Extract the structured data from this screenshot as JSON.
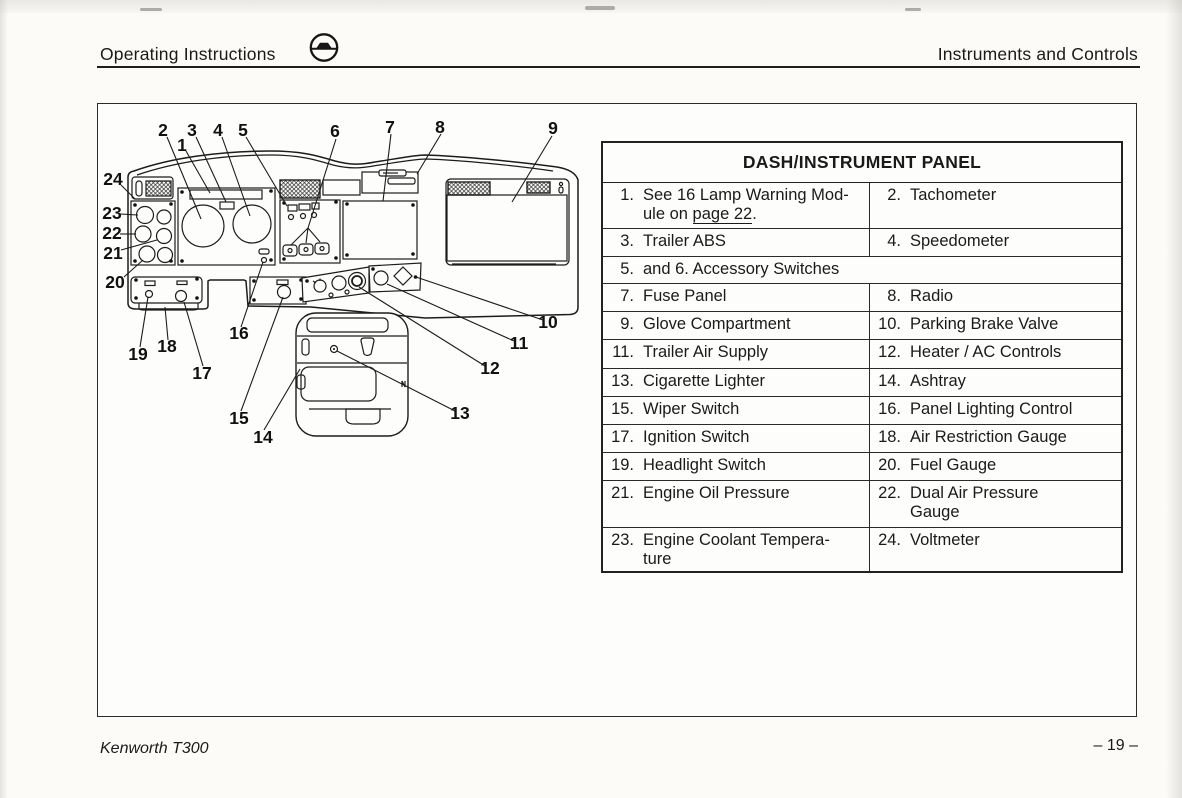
{
  "header": {
    "left": "Operating Instructions",
    "right": "Instruments and Controls",
    "icon": "steering-wheel-icon"
  },
  "footer": {
    "model": "Kenworth T300",
    "page": "– 19 –"
  },
  "table": {
    "title": "DASH/INSTRUMENT PANEL",
    "rows": [
      {
        "ln": "1.",
        "lt_pre": "See 16 Lamp Warning Mod-ule on ",
        "lt_link": "page 22",
        "lt_post": ".",
        "rn": "2.",
        "rt": "Tachometer"
      },
      {
        "ln": "3.",
        "lt": "Trailer ABS",
        "rn": "4.",
        "rt": "Speedometer"
      },
      {
        "n": "5.",
        "label": "and 6. Accessory Switches"
      },
      {
        "ln": "7.",
        "lt": "Fuse Panel",
        "rn": "8.",
        "rt": "Radio"
      },
      {
        "ln": "9.",
        "lt": "Glove Compartment",
        "rn": "10.",
        "rt": "Parking Brake Valve"
      },
      {
        "ln": "11.",
        "lt": "Trailer Air Supply",
        "rn": "12.",
        "rt": "Heater / AC Controls"
      },
      {
        "ln": "13.",
        "lt": "Cigarette Lighter",
        "rn": "14.",
        "rt": "Ashtray"
      },
      {
        "ln": "15.",
        "lt": "Wiper Switch",
        "rn": "16.",
        "rt": "Panel Lighting Control"
      },
      {
        "ln": "17.",
        "lt": "Ignition Switch",
        "rn": "18.",
        "rt": "Air Restriction Gauge"
      },
      {
        "ln": "19.",
        "lt": "Headlight Switch",
        "rn": "20.",
        "rt": "Fuel Gauge"
      },
      {
        "ln": "21.",
        "lt": "Engine Oil Pressure",
        "rn": "22.",
        "rt": "Dual Air Pressure Gauge"
      },
      {
        "ln": "23.",
        "lt": "Engine Coolant Tempera-ture",
        "rn": "24.",
        "rt": "Voltmeter"
      }
    ]
  },
  "diagram": {
    "callouts": [
      "1",
      "2",
      "3",
      "4",
      "5",
      "6",
      "7",
      "8",
      "9",
      "10",
      "11",
      "12",
      "13",
      "14",
      "15",
      "16",
      "17",
      "18",
      "19",
      "20",
      "21",
      "22",
      "23",
      "24"
    ]
  }
}
